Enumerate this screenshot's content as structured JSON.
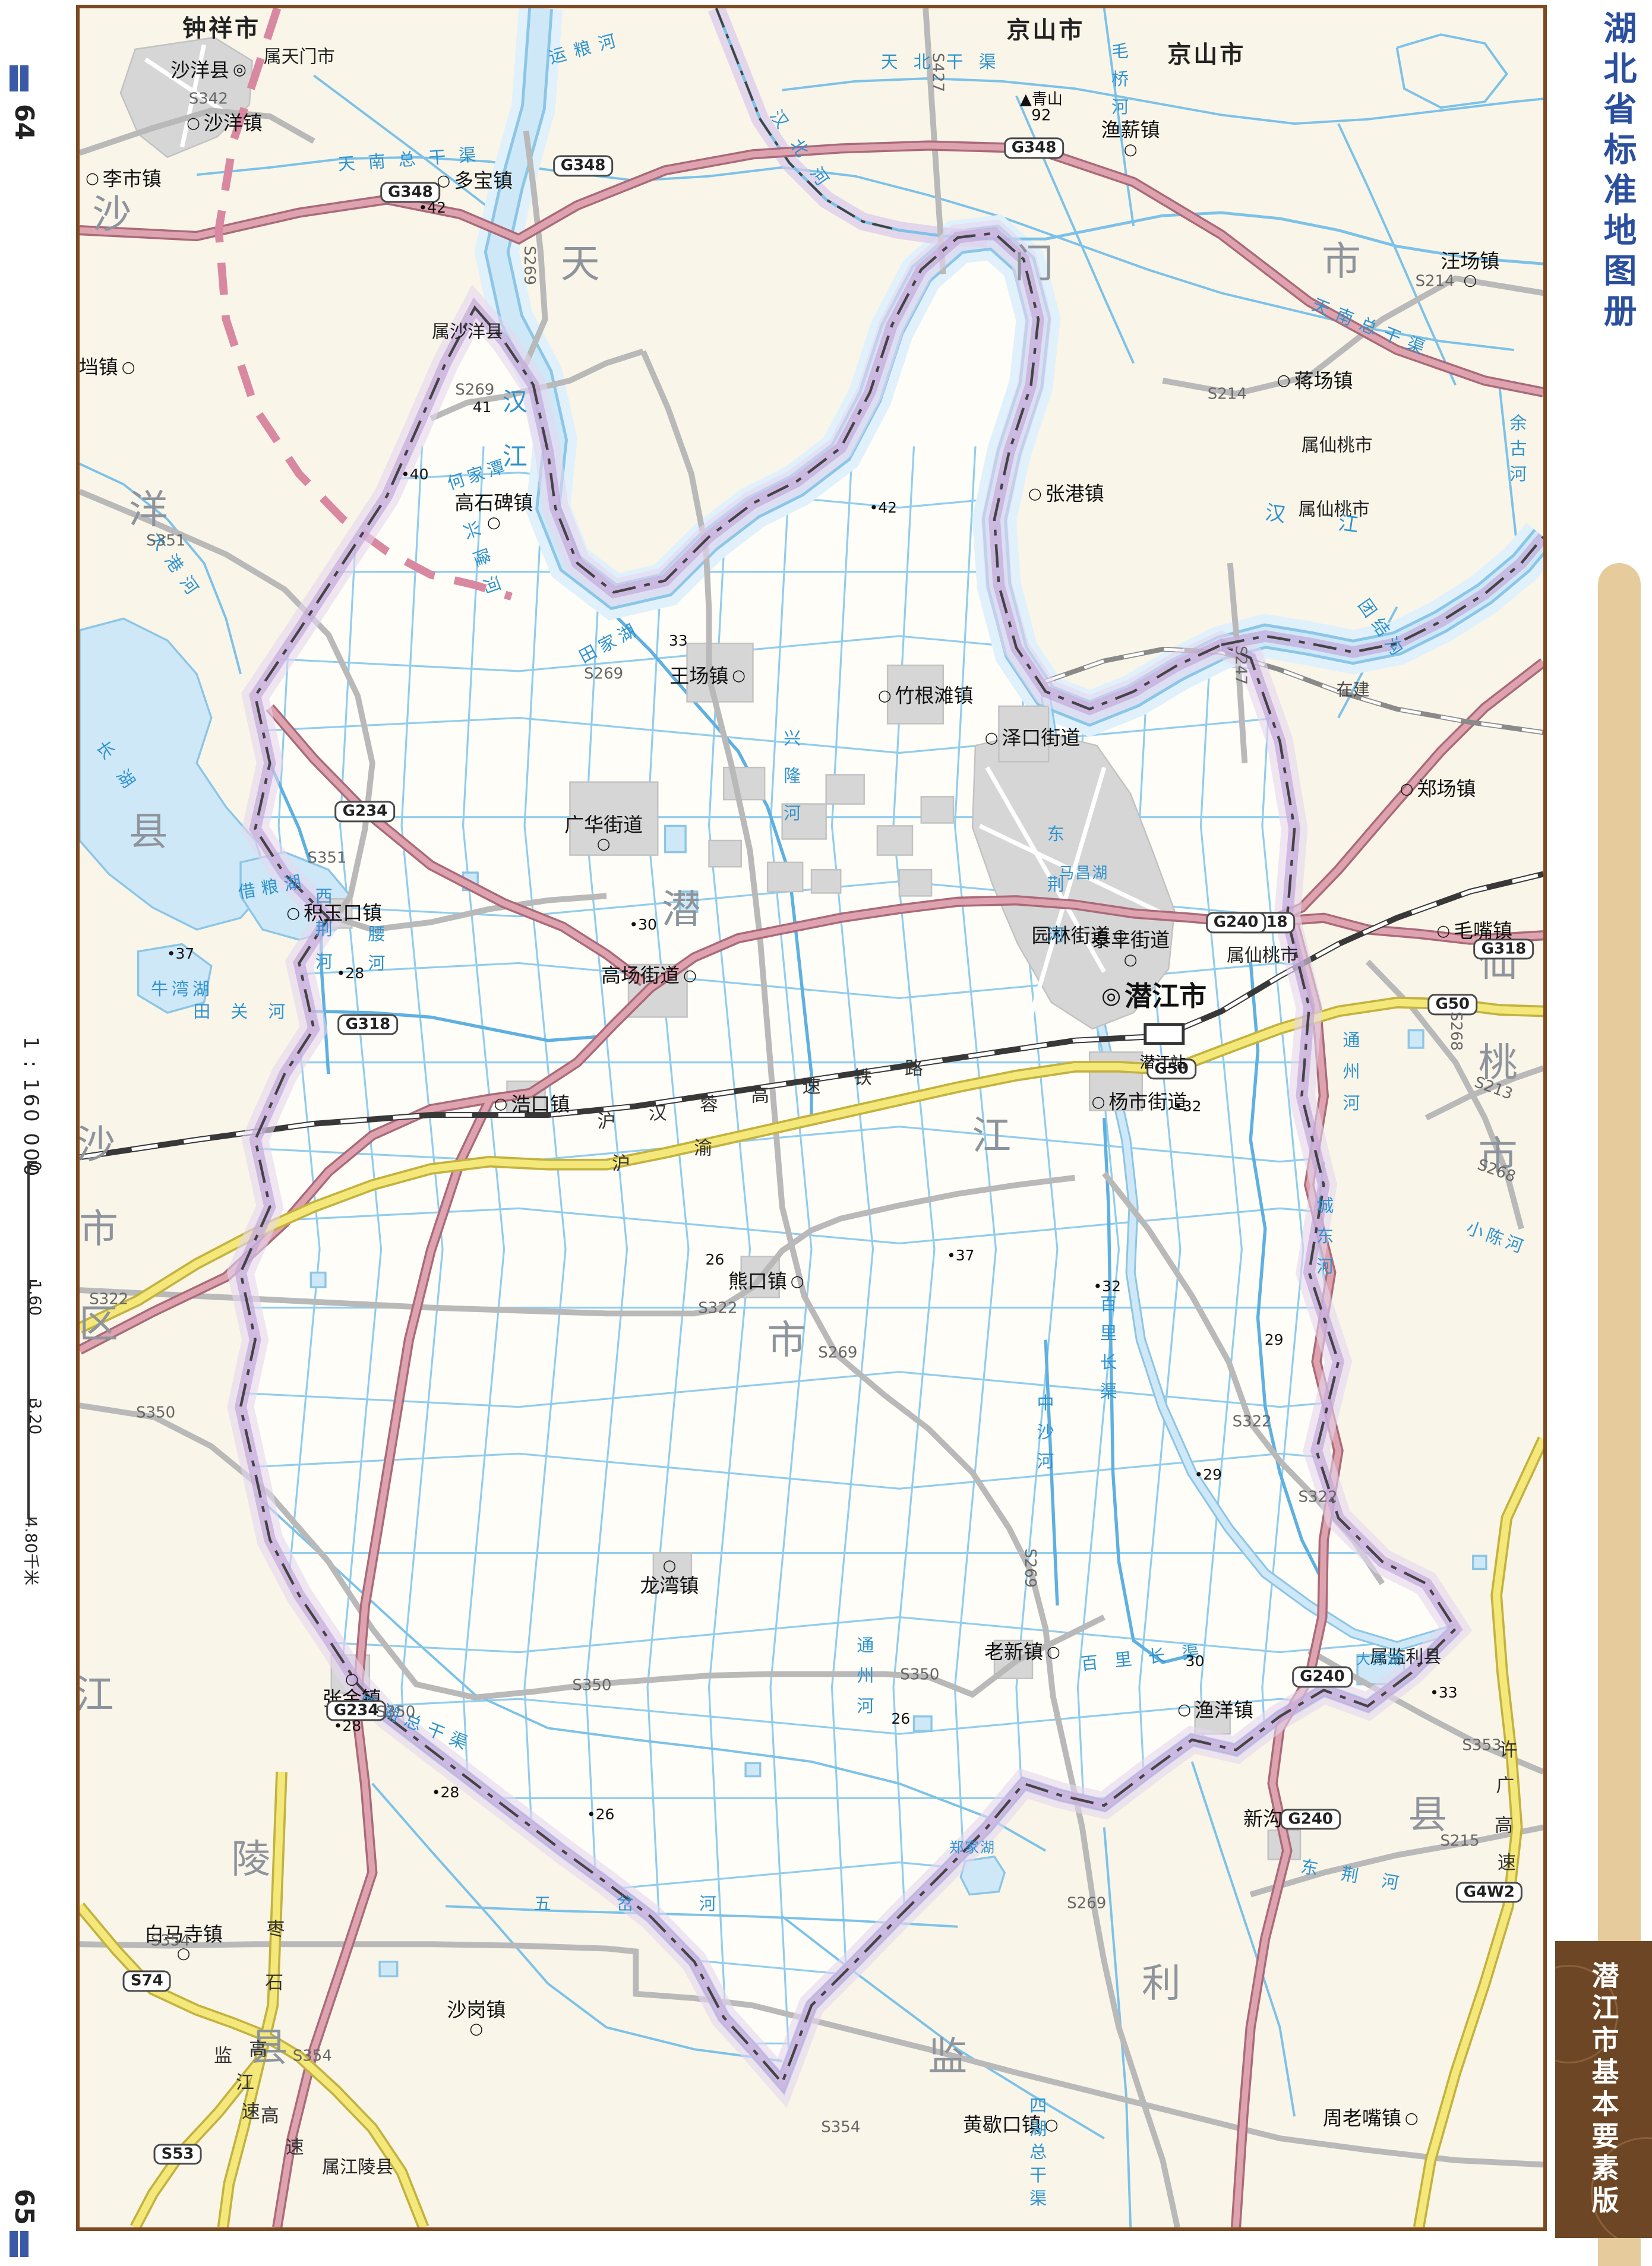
{
  "page": {
    "left_page_number": "64",
    "right_page_number": "65",
    "scale_text": "1 : 160 000",
    "scale_ticks": [
      "0",
      "1.60",
      "3.20",
      "4.80千米"
    ],
    "series_title": "湖北省标准地图册",
    "sheet_title": "潜江市基本要素版"
  },
  "colors": {
    "paper": "#faf5e9",
    "region_fill": "#fffdf7",
    "water_fill": "#cfe8f7",
    "water_edge": "#8cc6e6",
    "canal": "#7cc2e8",
    "boundary_purple": "#c2a5d8",
    "boundary_line": "#444444",
    "city_boundary_pink": "#d988a2",
    "g_road": "#d893a0",
    "expressway": "#f2e47a",
    "s_road": "#b9b9b9",
    "railway": "#383838",
    "urban": "#d6d6d6",
    "title_blue": "#2b4f9f",
    "banner_brown": "#6d4725",
    "band_tan": "#e6cc9c",
    "region_char": "#8e949c"
  },
  "map": {
    "region_groups": [
      {
        "group": "沙洋县",
        "chars": [
          {
            "t": "沙",
            "x": 2.2,
            "y": 9.3
          },
          {
            "t": "洋",
            "x": 4.7,
            "y": 22.6
          },
          {
            "t": "县",
            "x": 4.7,
            "y": 37.1
          }
        ]
      },
      {
        "group": "天门市",
        "chars": [
          {
            "t": "天",
            "x": 34.2,
            "y": 11.5
          },
          {
            "t": "门",
            "x": 65.2,
            "y": 11.5
          },
          {
            "t": "市",
            "x": 86.2,
            "y": 11.4
          }
        ]
      },
      {
        "group": "仙桃市",
        "chars": [
          {
            "t": "仙",
            "x": 96.9,
            "y": 43.0
          },
          {
            "t": "桃",
            "x": 96.9,
            "y": 47.5
          },
          {
            "t": "市",
            "x": 96.9,
            "y": 51.7
          }
        ]
      },
      {
        "group": "沙市区",
        "chars": [
          {
            "t": "沙",
            "x": 1.1,
            "y": 51.2
          },
          {
            "t": "市",
            "x": 1.3,
            "y": 55.0
          },
          {
            "t": "区",
            "x": 1.3,
            "y": 59.3
          }
        ]
      },
      {
        "group": "江陵县",
        "chars": [
          {
            "t": "江",
            "x": 1.0,
            "y": 76.0
          },
          {
            "t": "陵",
            "x": 11.7,
            "y": 83.4
          },
          {
            "t": "县",
            "x": 12.9,
            "y": 91.9
          }
        ]
      },
      {
        "group": "监利县",
        "chars": [
          {
            "t": "监",
            "x": 59.3,
            "y": 92.3
          },
          {
            "t": "利",
            "x": 73.9,
            "y": 89.0
          },
          {
            "t": "县",
            "x": 92.1,
            "y": 81.4
          }
        ]
      },
      {
        "group": "潜江市",
        "chars": [
          {
            "t": "潜",
            "x": 41.1,
            "y": 40.6
          },
          {
            "t": "江",
            "x": 62.3,
            "y": 50.8
          },
          {
            "t": "市",
            "x": 48.3,
            "y": 60.0
          }
        ]
      }
    ],
    "city_names": [
      {
        "t": "钟祥市",
        "x": 9.7,
        "y": 0.9
      },
      {
        "t": "京山市",
        "x": 66.0,
        "y": 1.0
      },
      {
        "t": "京山市",
        "x": 77.0,
        "y": 2.1
      }
    ],
    "annex_labels": [
      {
        "t": "属天门市",
        "x": 15.0,
        "y": 2.2
      },
      {
        "t": "属沙洋县",
        "x": 26.5,
        "y": 14.6
      },
      {
        "t": "属仙桃市",
        "x": 85.9,
        "y": 19.7
      },
      {
        "t": "属仙桃市",
        "x": 85.7,
        "y": 22.6
      },
      {
        "t": "属仙桃市",
        "x": 80.8,
        "y": 42.7
      },
      {
        "t": "属监利县",
        "x": 90.6,
        "y": 74.3
      },
      {
        "t": "属江陵县",
        "x": 19.0,
        "y": 97.3
      }
    ],
    "towns": [
      {
        "t": "沙洋县",
        "x": 8.8,
        "y": 2.8,
        "s": "r",
        "k": "county"
      },
      {
        "t": "沙洋镇",
        "x": 9.9,
        "y": 5.2,
        "s": "l",
        "k": "town"
      },
      {
        "t": "李市镇",
        "x": 3.0,
        "y": 7.7,
        "s": "l",
        "k": "town"
      },
      {
        "t": "官垱镇",
        "x": 1.2,
        "y": 16.2,
        "s": "r",
        "k": "town"
      },
      {
        "t": "多宝镇",
        "x": 27.0,
        "y": 7.8,
        "s": "l",
        "k": "town"
      },
      {
        "t": "渔薪镇",
        "x": 71.8,
        "y": 5.9,
        "s": "b",
        "k": "town"
      },
      {
        "t": "汪场镇",
        "x": 95.0,
        "y": 11.8,
        "s": "b",
        "k": "town"
      },
      {
        "t": "蒋场镇",
        "x": 84.4,
        "y": 16.8,
        "s": "l",
        "k": "town"
      },
      {
        "t": "张港镇",
        "x": 67.4,
        "y": 21.9,
        "s": "l",
        "k": "town"
      },
      {
        "t": "高石碑镇",
        "x": 28.3,
        "y": 22.7,
        "s": "b",
        "k": "town"
      },
      {
        "t": "王场镇",
        "x": 42.9,
        "y": 30.1,
        "s": "r",
        "k": "town"
      },
      {
        "t": "竹根滩镇",
        "x": 57.8,
        "y": 31.0,
        "s": "l",
        "k": "town"
      },
      {
        "t": "泽口街道",
        "x": 65.1,
        "y": 32.9,
        "s": "l",
        "k": "town"
      },
      {
        "t": "郑场镇",
        "x": 92.8,
        "y": 35.2,
        "s": "l",
        "k": "town"
      },
      {
        "t": "广华街道",
        "x": 35.8,
        "y": 37.2,
        "s": "b",
        "k": "town"
      },
      {
        "t": "积玉口镇",
        "x": 17.4,
        "y": 40.8,
        "s": "l",
        "k": "town"
      },
      {
        "t": "园林街道",
        "x": 68.3,
        "y": 41.8,
        "s": "r",
        "k": "town"
      },
      {
        "t": "泰丰街道",
        "x": 71.8,
        "y": 42.4,
        "s": "b",
        "k": "town"
      },
      {
        "t": "潜江市",
        "x": 73.4,
        "y": 44.5,
        "s": "l",
        "k": "city"
      },
      {
        "t": "高场街道",
        "x": 38.9,
        "y": 43.6,
        "s": "r",
        "k": "town"
      },
      {
        "t": "毛嘴镇",
        "x": 95.3,
        "y": 41.6,
        "s": "l",
        "k": "town"
      },
      {
        "t": "浩口镇",
        "x": 30.9,
        "y": 49.4,
        "s": "l",
        "k": "town"
      },
      {
        "t": "杨市街道",
        "x": 72.4,
        "y": 49.3,
        "s": "l",
        "k": "town"
      },
      {
        "t": "熊口镇",
        "x": 46.9,
        "y": 57.4,
        "s": "r",
        "k": "town"
      },
      {
        "t": "龙湾镇",
        "x": 40.3,
        "y": 70.7,
        "s": "a",
        "k": "town"
      },
      {
        "t": "张金镇",
        "x": 18.6,
        "y": 75.8,
        "s": "a",
        "k": "town"
      },
      {
        "t": "老新镇",
        "x": 64.4,
        "y": 74.1,
        "s": "r",
        "k": "town"
      },
      {
        "t": "渔洋镇",
        "x": 77.6,
        "y": 76.7,
        "s": "l",
        "k": "town"
      },
      {
        "t": "新沟镇",
        "x": 82.1,
        "y": 81.6,
        "s": "r",
        "k": "town"
      },
      {
        "t": "白马寺镇",
        "x": 7.1,
        "y": 87.2,
        "s": "b",
        "k": "town"
      },
      {
        "t": "沙岗镇",
        "x": 27.1,
        "y": 90.6,
        "s": "b",
        "k": "town"
      },
      {
        "t": "黄歇口镇",
        "x": 63.6,
        "y": 95.4,
        "s": "r",
        "k": "town"
      },
      {
        "t": "周老嘴镇",
        "x": 88.2,
        "y": 95.1,
        "s": "r",
        "k": "town"
      }
    ],
    "rivers": [
      {
        "t": "汉江",
        "x": 29.6,
        "y": 19.6,
        "v": 1,
        "ls": 50,
        "size": 42
      },
      {
        "t": "汉江",
        "x": 86.0,
        "y": 23.2,
        "rot": 8,
        "ls": 90,
        "size": 34
      },
      {
        "t": "汉北河",
        "x": 49.5,
        "y": 6.6,
        "rot": 55,
        "ls": 30
      },
      {
        "t": "运粮河",
        "x": 34.6,
        "y": 1.8,
        "rot": -15,
        "ls": 14
      },
      {
        "t": "毛桥河",
        "x": 71.0,
        "y": 3.4,
        "v": 1,
        "ls": 18
      },
      {
        "t": "天北干渠",
        "x": 59.2,
        "y": 2.4,
        "ls": 26
      },
      {
        "t": "天南总干渠",
        "x": 22.8,
        "y": 6.8,
        "rot": -4,
        "ls": 22
      },
      {
        "t": "天南总干渠",
        "x": 88.3,
        "y": 14.4,
        "rot": 22,
        "ls": 14
      },
      {
        "t": "大港河",
        "x": 6.6,
        "y": 25.2,
        "rot": 55,
        "ls": 16
      },
      {
        "t": "何家潭",
        "x": 27.2,
        "y": 21.0,
        "rot": -18,
        "ls": 6
      },
      {
        "t": "兴隆河",
        "x": 27.6,
        "y": 25.0,
        "rot": 70,
        "ls": 20
      },
      {
        "t": "兴隆河",
        "x": 48.6,
        "y": 35.0,
        "v": 1,
        "ls": 34
      },
      {
        "t": "田家湖",
        "x": 36.2,
        "y": 28.6,
        "rot": -28,
        "ls": 8
      },
      {
        "t": "长湖",
        "x": 2.8,
        "y": 34.4,
        "rot": 55,
        "ls": 30
      },
      {
        "t": "借粮湖",
        "x": 13.2,
        "y": 39.6,
        "rot": -10,
        "ls": 10
      },
      {
        "t": "牛湾湖",
        "x": 7.0,
        "y": 44.2,
        "ls": 6
      },
      {
        "t": "西荆河",
        "x": 16.6,
        "y": 41.8,
        "v": 1,
        "ls": 26
      },
      {
        "t": "腰河",
        "x": 20.2,
        "y": 42.6,
        "v": 1,
        "ls": 20
      },
      {
        "t": "田关河",
        "x": 11.6,
        "y": 45.2,
        "ls": 34
      },
      {
        "t": "马昌湖",
        "x": 68.6,
        "y": 39.0,
        "ls": 2,
        "size": 26
      },
      {
        "t": "东荆河",
        "x": 66.6,
        "y": 40.2,
        "v": 1,
        "ls": 56
      },
      {
        "t": "东荆河",
        "x": 87.6,
        "y": 84.2,
        "rot": 10,
        "ls": 40
      },
      {
        "t": "通州河",
        "x": 86.8,
        "y": 48.2,
        "v": 1,
        "ls": 24
      },
      {
        "t": "通州河",
        "x": 53.6,
        "y": 75.4,
        "v": 1,
        "ls": 22
      },
      {
        "t": "城东河",
        "x": 85.0,
        "y": 55.6,
        "v": 1,
        "ls": 22
      },
      {
        "t": "百里长渠",
        "x": 73.0,
        "y": 74.3,
        "rot": -6,
        "ls": 28
      },
      {
        "t": "百里长渠",
        "x": 70.2,
        "y": 60.6,
        "v": 1,
        "ls": 20
      },
      {
        "t": "中沙河",
        "x": 65.9,
        "y": 64.4,
        "v": 1,
        "ls": 20
      },
      {
        "t": "四湖总干渠",
        "x": 23.0,
        "y": 77.3,
        "rot": 22,
        "ls": 12
      },
      {
        "t": "四湖总干渠",
        "x": 65.4,
        "y": 96.7,
        "v": 1,
        "ls": 10
      },
      {
        "t": "五岔河",
        "x": 39.5,
        "y": 85.4,
        "ls": 110
      },
      {
        "t": "郑家湖",
        "x": 61.0,
        "y": 82.9,
        "ls": 2,
        "size": 24
      },
      {
        "t": "大苏湖",
        "x": 88.8,
        "y": 74.4,
        "ls": 2,
        "size": 24
      },
      {
        "t": "小陈河",
        "x": 96.8,
        "y": 55.4,
        "rot": 20,
        "ls": 6
      },
      {
        "t": "团结沟",
        "x": 89.0,
        "y": 28.0,
        "rot": 55,
        "ls": 10
      },
      {
        "t": "余古河",
        "x": 98.2,
        "y": 20.0,
        "v": 1,
        "ls": 14
      }
    ],
    "road_badges": [
      {
        "t": "G348",
        "x": 22.6,
        "y": 8.3
      },
      {
        "t": "G348",
        "x": 34.4,
        "y": 7.1
      },
      {
        "t": "G348",
        "x": 65.2,
        "y": 6.3
      },
      {
        "t": "G318",
        "x": 19.7,
        "y": 45.8
      },
      {
        "t": "G318",
        "x": 81.0,
        "y": 41.2
      },
      {
        "t": "G318",
        "x": 97.3,
        "y": 42.4
      },
      {
        "t": "G240",
        "x": 79.0,
        "y": 41.2
      },
      {
        "t": "G240",
        "x": 84.9,
        "y": 75.2
      },
      {
        "t": "G240",
        "x": 84.1,
        "y": 81.6
      },
      {
        "t": "G50",
        "x": 74.6,
        "y": 47.8
      },
      {
        "t": "G50",
        "x": 93.8,
        "y": 44.9
      },
      {
        "t": "G234",
        "x": 19.5,
        "y": 36.2
      },
      {
        "t": "G234",
        "x": 18.9,
        "y": 76.7
      },
      {
        "t": "G4W2",
        "x": 96.3,
        "y": 84.9
      },
      {
        "t": "S74",
        "x": 4.6,
        "y": 88.9
      },
      {
        "t": "S53",
        "x": 6.7,
        "y": 96.7
      }
    ],
    "road_labels": [
      {
        "t": "S342",
        "x": 8.8,
        "y": 4.1
      },
      {
        "t": "S427",
        "x": 58.6,
        "y": 2.9,
        "v": 1
      },
      {
        "t": "S214",
        "x": 92.6,
        "y": 12.3
      },
      {
        "t": "S214",
        "x": 78.4,
        "y": 17.4
      },
      {
        "t": "S269",
        "x": 30.7,
        "y": 11.6,
        "v": 1
      },
      {
        "t": "S269",
        "x": 27.0,
        "y": 17.2
      },
      {
        "t": "S269",
        "x": 35.8,
        "y": 30.0
      },
      {
        "t": "S269",
        "x": 51.8,
        "y": 60.6
      },
      {
        "t": "S269",
        "x": 64.9,
        "y": 70.3,
        "v": 1
      },
      {
        "t": "S269",
        "x": 68.8,
        "y": 85.4
      },
      {
        "t": "S351",
        "x": 5.9,
        "y": 24.0
      },
      {
        "t": "S351",
        "x": 16.9,
        "y": 38.3
      },
      {
        "t": "S322",
        "x": 2.0,
        "y": 58.2
      },
      {
        "t": "S322",
        "x": 43.6,
        "y": 58.6
      },
      {
        "t": "S322",
        "x": 80.1,
        "y": 63.7
      },
      {
        "t": "S322",
        "x": 84.6,
        "y": 67.1
      },
      {
        "t": "S350",
        "x": 5.2,
        "y": 63.3
      },
      {
        "t": "S350",
        "x": 21.6,
        "y": 76.8
      },
      {
        "t": "S350",
        "x": 35.0,
        "y": 75.6
      },
      {
        "t": "S350",
        "x": 57.4,
        "y": 75.1
      },
      {
        "t": "S354",
        "x": 6.2,
        "y": 87.1
      },
      {
        "t": "S354",
        "x": 15.9,
        "y": 92.3
      },
      {
        "t": "S354",
        "x": 52.0,
        "y": 95.5
      },
      {
        "t": "S353",
        "x": 95.8,
        "y": 78.3
      },
      {
        "t": "S215",
        "x": 94.3,
        "y": 82.6
      },
      {
        "t": "S268",
        "x": 94.0,
        "y": 46.1,
        "v": 1
      },
      {
        "t": "S268",
        "x": 96.8,
        "y": 52.4,
        "rot": 20
      },
      {
        "t": "S213",
        "x": 96.6,
        "y": 48.7,
        "rot": 20
      },
      {
        "t": "S247",
        "x": 79.3,
        "y": 29.6,
        "v": 1
      }
    ],
    "expressway_name_chars": [
      {
        "t": "沪",
        "x": 37.0,
        "y": 52.1
      },
      {
        "t": "渝",
        "x": 42.6,
        "y": 51.4
      },
      {
        "t": "沪",
        "x": 36.0,
        "y": 50.2
      },
      {
        "t": "汉",
        "x": 39.5,
        "y": 49.8
      },
      {
        "t": "蓉",
        "x": 43.0,
        "y": 49.4
      },
      {
        "t": "高",
        "x": 46.5,
        "y": 49.0
      },
      {
        "t": "速",
        "x": 50.0,
        "y": 48.6
      },
      {
        "t": "铁",
        "x": 53.5,
        "y": 48.2
      },
      {
        "t": "路",
        "x": 57.0,
        "y": 47.8
      },
      {
        "t": "枣",
        "x": 13.4,
        "y": 86.6
      },
      {
        "t": "石",
        "x": 13.3,
        "y": 89.0
      },
      {
        "t": "高",
        "x": 12.2,
        "y": 92.0
      },
      {
        "t": "速",
        "x": 11.7,
        "y": 94.8
      },
      {
        "t": "监",
        "x": 9.8,
        "y": 92.3
      },
      {
        "t": "江",
        "x": 11.3,
        "y": 93.5
      },
      {
        "t": "高",
        "x": 13.0,
        "y": 95.0
      },
      {
        "t": "速",
        "x": 14.7,
        "y": 96.4
      },
      {
        "t": "许",
        "x": 97.6,
        "y": 78.5
      },
      {
        "t": "广",
        "x": 97.4,
        "y": 80.1
      },
      {
        "t": "高",
        "x": 97.3,
        "y": 81.9
      },
      {
        "t": "速",
        "x": 97.5,
        "y": 83.6
      }
    ],
    "spot_heights": [
      {
        "t": "•42",
        "x": 24.1,
        "y": 9.0
      },
      {
        "t": "41",
        "x": 27.5,
        "y": 18.0
      },
      {
        "t": "•40",
        "x": 22.9,
        "y": 21.0
      },
      {
        "t": "•42",
        "x": 54.9,
        "y": 22.5
      },
      {
        "t": "33",
        "x": 40.9,
        "y": 28.5
      },
      {
        "t": "•30",
        "x": 38.5,
        "y": 41.3
      },
      {
        "t": "•37",
        "x": 6.9,
        "y": 42.6
      },
      {
        "t": "•28",
        "x": 18.5,
        "y": 43.5
      },
      {
        "t": "•32",
        "x": 75.7,
        "y": 49.5
      },
      {
        "t": "•37",
        "x": 60.2,
        "y": 56.2
      },
      {
        "t": "26",
        "x": 43.4,
        "y": 56.4
      },
      {
        "t": "•32",
        "x": 70.2,
        "y": 57.6
      },
      {
        "t": "29",
        "x": 81.6,
        "y": 60.0
      },
      {
        "t": "•29",
        "x": 77.1,
        "y": 66.1
      },
      {
        "t": "•28",
        "x": 18.3,
        "y": 77.4
      },
      {
        "t": "•28",
        "x": 25.0,
        "y": 80.4
      },
      {
        "t": "•26",
        "x": 35.6,
        "y": 81.4
      },
      {
        "t": "26",
        "x": 56.1,
        "y": 77.1
      },
      {
        "t": "30",
        "x": 76.2,
        "y": 74.5
      },
      {
        "t": "•33",
        "x": 93.2,
        "y": 75.9
      }
    ],
    "peak": {
      "name": "青山",
      "elev": "92",
      "x": 65.7,
      "y": 4.5
    },
    "station": {
      "name": "潜江站",
      "x": 74.0,
      "y": 47.4
    },
    "misc_labels": [
      {
        "t": "在建",
        "x": 87.0,
        "y": 30.7
      }
    ]
  }
}
